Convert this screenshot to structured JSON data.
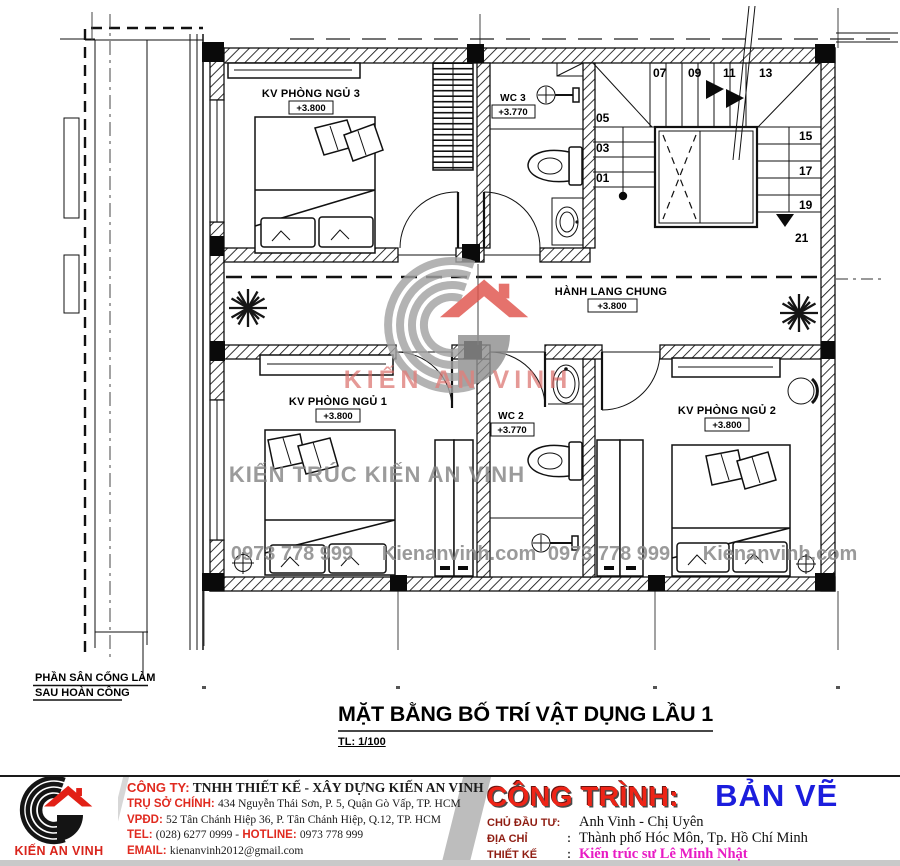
{
  "plan": {
    "rooms": {
      "bedroom3": {
        "label": "KV PHÒNG NGỦ 3",
        "level": "+3.800"
      },
      "wc3": {
        "label": "WC 3",
        "level": "+3.770"
      },
      "hallway": {
        "label": "HÀNH LANG CHUNG",
        "level": "+3.800"
      },
      "bedroom1": {
        "label": "KV PHÒNG NGỦ 1",
        "level": "+3.800"
      },
      "wc2": {
        "label": "WC 2",
        "level": "+3.770"
      },
      "bedroom2": {
        "label": "KV PHÒNG NGỦ 2",
        "level": "+3.800"
      }
    },
    "stairs": {
      "n01": "01",
      "n03": "03",
      "n05": "05",
      "n07": "07",
      "n09": "09",
      "n11": "11",
      "n13": "13",
      "n15": "15",
      "n17": "17",
      "n19": "19",
      "n21": "21"
    },
    "note": {
      "line1": "PHẦN SÂN CỐNG LÀM",
      "line2": "SAU HOÀN CÔNG"
    }
  },
  "watermarks": {
    "brand_text": "KIẾN AN VINH",
    "center_text": "KIẾN TRÚC KIẾN AN VINH",
    "phone": "0973 778 999",
    "site": "Kienanvinh.com"
  },
  "title": {
    "text": "MẶT BẰNG BỐ TRÍ VẬT DỤNG LẦU 1",
    "scale": "TL: 1/100"
  },
  "footer": {
    "logo_text": "KIẾN AN VINH",
    "company": {
      "l1_label": "CÔNG TY:",
      "l1_value": "TNHH THIẾT KẾ - XÂY DỰNG KIẾN AN VINH",
      "l2_label": "TRỤ SỞ CHÍNH:",
      "l2_value": "434 Nguyễn Thái Sơn, P. 5, Quận Gò Vấp, TP. HCM",
      "l3_label": "VPĐD:",
      "l3_value": "52 Tân Chánh Hiệp 36, P. Tân Chánh Hiệp, Q.12, TP. HCM",
      "l4_label": "TEL:",
      "l4_value": "(028) 6277 0999 -",
      "l4_label2": "HOTLINE:",
      "l4_value2": "0973 778 999",
      "l5_label": "EMAIL:",
      "l5_value": "kienanvinh2012@gmail.com"
    },
    "project": {
      "title_label": "CÔNG TRÌNH:",
      "title_value": "BẢN VẼ",
      "owner_label": "CHỦ ĐẦU TƯ:",
      "owner_value": "Anh Vinh - Chị Uyên",
      "address_label": "ĐỊA CHỈ",
      "address_sep": ":",
      "address_value": "Thành phố Hóc Môn, Tp. Hồ Chí Minh",
      "designer_label": "THIẾT KẾ",
      "designer_sep": ":",
      "designer_value": "Kiến trúc sư Lê Minh Nhật"
    }
  },
  "colors": {
    "accent_red": "#e02a1f",
    "title_blue": "#1b1ddd",
    "designer_magenta": "#e81bc4",
    "maroon_label": "#8f1d12",
    "watermark_gray": "#8d8d8d",
    "logo_red": "#e22016"
  }
}
